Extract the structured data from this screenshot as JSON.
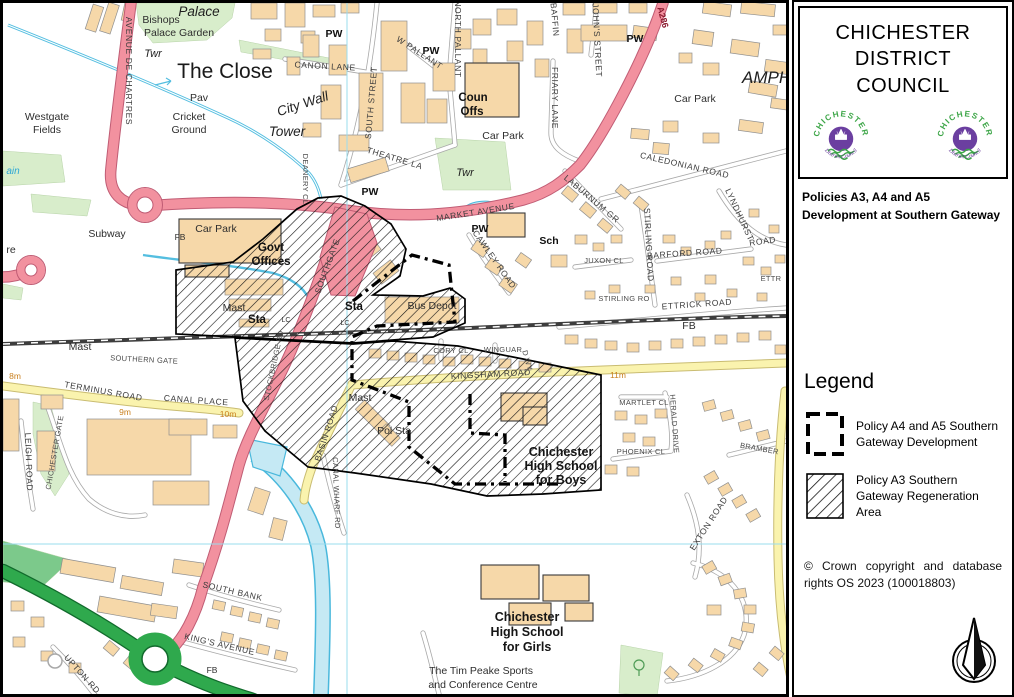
{
  "panel": {
    "title": "CHICHESTER DISTRICT COUNCIL",
    "policies": "Policies A3, A4  and  A5\nDevelopment  at Southern Gateway",
    "legend": {
      "heading": "Legend",
      "items": [
        {
          "swatch": "dashed-outline",
          "label": "Policy  A4 and A5 Southern Gateway Development"
        },
        {
          "swatch": "diagonal-hatch",
          "label": "Policy A3 Southern Gateway Regeneration Area"
        }
      ]
    },
    "copyright": "© Crown copyright and database rights OS 2023 (100018803)",
    "logo": {
      "top": "CHICHESTER",
      "bottom": "District Council"
    },
    "compass": "north-arrow"
  },
  "colors": {
    "a_road_pink": "#F2919F",
    "primary_green": "#2FA94D",
    "minor_yellow": "#FAF3AE",
    "building": "#F6D8A9",
    "water": "#C5E9F4",
    "hatch_black": "#151515"
  },
  "map": {
    "labels": [
      {
        "t": "Palace",
        "x": 196,
        "y": 13,
        "c": "serif"
      },
      {
        "t": "Bishops",
        "x": 158,
        "y": 20,
        "c": "name"
      },
      {
        "t": "Palace Garden",
        "x": 176,
        "y": 33,
        "c": "name"
      },
      {
        "t": "The Close",
        "x": 222,
        "y": 75,
        "c": "lg"
      },
      {
        "t": "Twr",
        "x": 150,
        "y": 54,
        "c": "serif-sm"
      },
      {
        "t": "City Wall",
        "x": 301,
        "y": 105,
        "c": "serif",
        "r": -18
      },
      {
        "t": "Tower",
        "x": 284,
        "y": 133,
        "c": "serif"
      },
      {
        "t": "Pav",
        "x": 196,
        "y": 98,
        "c": "name"
      },
      {
        "t": "Cricket",
        "x": 186,
        "y": 117,
        "c": "name"
      },
      {
        "t": "Ground",
        "x": 186,
        "y": 130,
        "c": "name"
      },
      {
        "t": "Westgate",
        "x": 44,
        "y": 117,
        "c": "name"
      },
      {
        "t": "Fields",
        "x": 44,
        "y": 130,
        "c": "name"
      },
      {
        "t": "AVENUE DE CHARTRES",
        "x": 123,
        "y": 68,
        "c": "road",
        "r": 90
      },
      {
        "t": "PW",
        "x": 331,
        "y": 34,
        "c": "bold-sm"
      },
      {
        "t": "PW",
        "x": 428,
        "y": 51,
        "c": "bold-sm"
      },
      {
        "t": "PW",
        "x": 632,
        "y": 39,
        "c": "bold-sm"
      },
      {
        "t": "PW",
        "x": 367,
        "y": 192,
        "c": "bold-sm"
      },
      {
        "t": "PW",
        "x": 477,
        "y": 229,
        "c": "bold-sm"
      },
      {
        "t": "CANON LANE",
        "x": 322,
        "y": 66,
        "c": "road",
        "r": 3
      },
      {
        "t": "SOUTH STREET",
        "x": 371,
        "y": 100,
        "c": "road",
        "r": -85
      },
      {
        "t": "W PALLANT",
        "x": 415,
        "y": 52,
        "c": "road",
        "r": 33
      },
      {
        "t": "NORTH PALLANT",
        "x": 452,
        "y": 36,
        "c": "road",
        "r": 90
      },
      {
        "t": "THEATRE LA",
        "x": 391,
        "y": 158,
        "c": "road",
        "r": 17
      },
      {
        "t": "FRIARY LANE",
        "x": 549,
        "y": 95,
        "c": "road",
        "r": 90
      },
      {
        "t": "BAFFIN",
        "x": 549,
        "y": 17,
        "c": "road",
        "r": 85
      },
      {
        "t": "ST JOHN'S STREET",
        "x": 591,
        "y": 30,
        "c": "road",
        "r": 87
      },
      {
        "t": "A286",
        "x": 657,
        "y": 15,
        "c": "red",
        "r": 75
      },
      {
        "t": "Coun",
        "x": 470,
        "y": 98,
        "c": "bold"
      },
      {
        "t": "Offs",
        "x": 469,
        "y": 112,
        "c": "bold"
      },
      {
        "t": "Car Park",
        "x": 500,
        "y": 136,
        "c": "name"
      },
      {
        "t": "Car Park",
        "x": 692,
        "y": 99,
        "c": "name"
      },
      {
        "t": "Car Park",
        "x": 213,
        "y": 229,
        "c": "name"
      },
      {
        "t": "Twr",
        "x": 462,
        "y": 173,
        "c": "serif-sm"
      },
      {
        "t": "AMPHITHEATRE",
        "x": 805,
        "y": 80,
        "c": "serif-lg"
      },
      {
        "t": "CALEDONIAN ROAD",
        "x": 681,
        "y": 165,
        "c": "road",
        "r": 13
      },
      {
        "t": "LABURNUM GR",
        "x": 587,
        "y": 198,
        "c": "road",
        "r": 40
      },
      {
        "t": "STIRLING ROAD",
        "x": 643,
        "y": 242,
        "c": "road",
        "r": 87
      },
      {
        "t": "STIRLING RO",
        "x": 621,
        "y": 298,
        "c": "road-sm"
      },
      {
        "t": "BARFORD ROAD",
        "x": 682,
        "y": 253,
        "c": "road",
        "r": -4
      },
      {
        "t": "JUXON CL",
        "x": 601,
        "y": 260,
        "c": "road-sm"
      },
      {
        "t": "LYNDHURST",
        "x": 734,
        "y": 213,
        "c": "road",
        "r": 65
      },
      {
        "t": "ROAD",
        "x": 760,
        "y": 241,
        "c": "road",
        "r": -8
      },
      {
        "t": "ETTRICK ROAD",
        "x": 694,
        "y": 304,
        "c": "road",
        "r": -4
      },
      {
        "t": "ETTR",
        "x": 768,
        "y": 278,
        "c": "road-sm"
      },
      {
        "t": "MARKET AVENUE",
        "x": 473,
        "y": 212,
        "c": "road",
        "r": -9
      },
      {
        "t": "CAWLEY ROAD",
        "x": 489,
        "y": 258,
        "c": "road",
        "r": 55
      },
      {
        "t": "SOUTHGATE",
        "x": 327,
        "y": 264,
        "c": "road",
        "r": -70
      },
      {
        "t": "DEANERY CL",
        "x": 300,
        "y": 176,
        "c": "road-sm",
        "r": 90
      },
      {
        "t": "Sch",
        "x": 546,
        "y": 241,
        "c": "bold-sm"
      },
      {
        "t": "Govt",
        "x": 268,
        "y": 248,
        "c": "bold"
      },
      {
        "t": "Offices",
        "x": 268,
        "y": 262,
        "c": "bold"
      },
      {
        "t": "Mast",
        "x": 231,
        "y": 308,
        "c": "name"
      },
      {
        "t": "Sta",
        "x": 254,
        "y": 320,
        "c": "bold"
      },
      {
        "t": "Sta",
        "x": 351,
        "y": 307,
        "c": "bold"
      },
      {
        "t": "LC",
        "x": 283,
        "y": 319,
        "c": "tiny"
      },
      {
        "t": "LC",
        "x": 342,
        "y": 322,
        "c": "tiny"
      },
      {
        "t": "Bus Depot",
        "x": 429,
        "y": 306,
        "c": "name"
      },
      {
        "t": "Mast",
        "x": 77,
        "y": 347,
        "c": "name"
      },
      {
        "t": "Mast",
        "x": 357,
        "y": 398,
        "c": "name"
      },
      {
        "t": "FB",
        "x": 177,
        "y": 237,
        "c": "name-sm"
      },
      {
        "t": "FB",
        "x": 686,
        "y": 326,
        "c": "name"
      },
      {
        "t": "FB",
        "x": 209,
        "y": 670,
        "c": "name-sm"
      },
      {
        "t": "Subway",
        "x": 104,
        "y": 234,
        "c": "name"
      },
      {
        "t": "TERMINUS ROAD",
        "x": 100,
        "y": 391,
        "c": "road",
        "r": 10
      },
      {
        "t": "CANAL PLACE",
        "x": 193,
        "y": 400,
        "c": "road",
        "r": 4
      },
      {
        "t": "9m",
        "x": 122,
        "y": 412,
        "c": "orange"
      },
      {
        "t": "10m",
        "x": 225,
        "y": 414,
        "c": "orange"
      },
      {
        "t": "8m",
        "x": 12,
        "y": 376,
        "c": "orange"
      },
      {
        "t": "11m",
        "x": 615,
        "y": 375,
        "c": "orange"
      },
      {
        "t": "KINGSHAM ROAD",
        "x": 488,
        "y": 374,
        "c": "road",
        "r": -3
      },
      {
        "t": "CORY CL",
        "x": 448,
        "y": 350,
        "c": "road-sm"
      },
      {
        "t": "WINGUAR",
        "x": 500,
        "y": 349,
        "c": "road-sm"
      },
      {
        "t": "D WY",
        "x": 522,
        "y": 358,
        "c": "road-sm",
        "r": 75
      },
      {
        "t": "BASIN ROAD",
        "x": 326,
        "y": 431,
        "c": "road",
        "r": -72
      },
      {
        "t": "CANAL WHARF RD",
        "x": 331,
        "y": 490,
        "c": "road-sm",
        "r": 88
      },
      {
        "t": "LEIGH ROAD",
        "x": 23,
        "y": 459,
        "c": "road",
        "r": 88
      },
      {
        "t": "CHICHESTER GATE",
        "x": 54,
        "y": 450,
        "c": "road-sm",
        "r": -80
      },
      {
        "t": "Pol Sta",
        "x": 391,
        "y": 431,
        "c": "name"
      },
      {
        "t": "Chichester",
        "x": 558,
        "y": 453,
        "c": "school"
      },
      {
        "t": "High School",
        "x": 558,
        "y": 467,
        "c": "school"
      },
      {
        "t": "for Boys",
        "x": 558,
        "y": 481,
        "c": "school"
      },
      {
        "t": "Chichester",
        "x": 524,
        "y": 618,
        "c": "school"
      },
      {
        "t": "High School",
        "x": 524,
        "y": 633,
        "c": "school"
      },
      {
        "t": "for Girls",
        "x": 524,
        "y": 648,
        "c": "school"
      },
      {
        "t": "The Tim Peake Sports",
        "x": 478,
        "y": 671,
        "c": "name"
      },
      {
        "t": "and Conference Centre",
        "x": 480,
        "y": 685,
        "c": "name"
      },
      {
        "t": "SOUTH BANK",
        "x": 229,
        "y": 591,
        "c": "road",
        "r": 13
      },
      {
        "t": "KING'S AVENUE",
        "x": 216,
        "y": 644,
        "c": "road",
        "r": 13
      },
      {
        "t": "UPTON RD",
        "x": 77,
        "y": 673,
        "c": "road",
        "r": 48
      },
      {
        "t": "MARTLET CL",
        "x": 641,
        "y": 402,
        "c": "road-sm"
      },
      {
        "t": "HERALD DRIVE",
        "x": 669,
        "y": 421,
        "c": "road-sm",
        "r": 86
      },
      {
        "t": "PHOENIX CL",
        "x": 638,
        "y": 451,
        "c": "road-sm"
      },
      {
        "t": "BRAMBER",
        "x": 756,
        "y": 448,
        "c": "road-sm",
        "r": 10
      },
      {
        "t": "EXTON ROAD",
        "x": 708,
        "y": 522,
        "c": "road",
        "r": -57
      },
      {
        "t": "STOCKBRIDGE RD",
        "x": 273,
        "y": 363,
        "c": "road-sm",
        "r": -78
      },
      {
        "t": "SOUTHERN GATE",
        "x": 141,
        "y": 359,
        "c": "road-sm",
        "r": 3
      },
      {
        "t": "ain",
        "x": 10,
        "y": 171,
        "c": "cyan"
      },
      {
        "t": "re",
        "x": 8,
        "y": 250,
        "c": "name"
      }
    ]
  }
}
